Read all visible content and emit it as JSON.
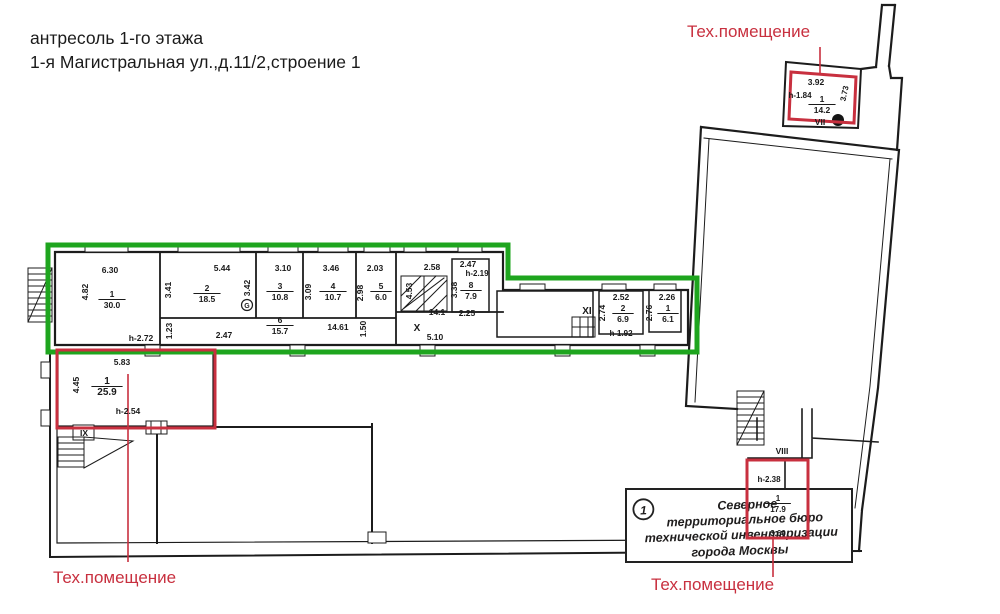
{
  "title": {
    "line1": "антресоль 1-го этажа",
    "line2": "1-я Магистральная ул.,д.11/2,строение 1"
  },
  "legend": {
    "tech_room_top_right": "Тех.помещение",
    "tech_room_bottom_left": "Тех.помещение",
    "tech_room_bottom_right": "Тех.помещение"
  },
  "stamp": {
    "number": "1",
    "lines": [
      "Северное",
      "территориальное бюро",
      "технической инвентаризации",
      "города Москвы"
    ]
  },
  "colors": {
    "highlight_green": "#1ea51e",
    "highlight_red": "#c8303f",
    "ink": "#1a1a1a"
  },
  "plan": {
    "labels": [
      {
        "t": "6.30",
        "x": 110,
        "y": 273
      },
      {
        "t": "4.82",
        "x": 88,
        "y": 292,
        "r": -90
      },
      {
        "t": "1",
        "x": 112,
        "y": 297,
        "fr": "30.0"
      },
      {
        "t": "h-2.72",
        "x": 141,
        "y": 341
      },
      {
        "t": "5.44",
        "x": 222,
        "y": 271
      },
      {
        "t": "3.41",
        "x": 171,
        "y": 290,
        "r": -90
      },
      {
        "t": "2",
        "x": 207,
        "y": 291,
        "fr": "18.5"
      },
      {
        "t": "3.42",
        "x": 250,
        "y": 288,
        "r": -90
      },
      {
        "t": "3.10",
        "x": 283,
        "y": 271
      },
      {
        "t": "3",
        "x": 280,
        "y": 289,
        "fr": "10.8"
      },
      {
        "t": "3.46",
        "x": 331,
        "y": 271
      },
      {
        "t": "3.09",
        "x": 311,
        "y": 292,
        "r": -90
      },
      {
        "t": "4",
        "x": 333,
        "y": 289,
        "fr": "10.7"
      },
      {
        "t": "2.03",
        "x": 375,
        "y": 271
      },
      {
        "t": "2.98",
        "x": 363,
        "y": 293,
        "r": -90
      },
      {
        "t": "5",
        "x": 381,
        "y": 289,
        "fr": "6.0"
      },
      {
        "t": "6",
        "x": 280,
        "y": 323,
        "fr": "15.7"
      },
      {
        "t": "1.23",
        "x": 172,
        "y": 331,
        "r": -90
      },
      {
        "t": "2.47",
        "x": 224,
        "y": 338
      },
      {
        "t": "14.61",
        "x": 338,
        "y": 330
      },
      {
        "t": "1.50",
        "x": 366,
        "y": 329,
        "r": -90
      },
      {
        "t": "2.58",
        "x": 432,
        "y": 270
      },
      {
        "t": "4.53",
        "x": 412,
        "y": 291,
        "r": -90
      },
      {
        "t": "14.1",
        "x": 437,
        "y": 315
      },
      {
        "t": "X",
        "x": 417,
        "y": 331,
        "b": 1,
        "s": 10
      },
      {
        "t": "5.10",
        "x": 435,
        "y": 340
      },
      {
        "t": "2.47",
        "x": 468,
        "y": 267
      },
      {
        "t": "h-2.19",
        "x": 477,
        "y": 276,
        "s": 8
      },
      {
        "t": "3.38",
        "x": 457,
        "y": 290,
        "r": -90
      },
      {
        "t": "8",
        "x": 471,
        "y": 288,
        "fr": "7.9"
      },
      {
        "t": "2.25",
        "x": 467,
        "y": 316
      },
      {
        "t": "XI",
        "x": 587,
        "y": 314,
        "b": 1,
        "s": 10
      },
      {
        "t": "2.52",
        "x": 621,
        "y": 300
      },
      {
        "t": "2.74",
        "x": 605,
        "y": 313,
        "r": -90
      },
      {
        "t": "2",
        "x": 623,
        "y": 311,
        "fr": "6.9"
      },
      {
        "t": "h-1.92",
        "x": 621,
        "y": 336,
        "s": 8
      },
      {
        "t": "2.26",
        "x": 667,
        "y": 300
      },
      {
        "t": "2.76",
        "x": 652,
        "y": 313,
        "r": -90
      },
      {
        "t": "1",
        "x": 668,
        "y": 311,
        "fr": "6.1"
      },
      {
        "t": "5.83",
        "x": 122,
        "y": 365
      },
      {
        "t": "4.45",
        "x": 79,
        "y": 385,
        "r": -90
      },
      {
        "t": "1",
        "x": 107,
        "y": 384,
        "fr": "25.9",
        "s": 10
      },
      {
        "t": "h-2.54",
        "x": 128,
        "y": 414
      },
      {
        "t": "IX",
        "x": 84,
        "y": 436,
        "b": 1
      },
      {
        "t": "3.92",
        "x": 816,
        "y": 85
      },
      {
        "t": "h-1.84",
        "x": 800,
        "y": 98,
        "s": 8
      },
      {
        "t": "3.73",
        "x": 847,
        "y": 94,
        "r": -78,
        "s": 8
      },
      {
        "t": "1",
        "x": 822,
        "y": 102,
        "fr": "14.2"
      },
      {
        "t": "VII",
        "x": 820,
        "y": 125,
        "b": 1
      },
      {
        "t": "VIII",
        "x": 782,
        "y": 454,
        "b": 1
      },
      {
        "t": "h-2.38",
        "x": 769,
        "y": 482,
        "s": 8
      },
      {
        "t": "1",
        "x": 778,
        "y": 501,
        "fr": "17.9",
        "s": 8
      },
      {
        "t": "3.60",
        "x": 778,
        "y": 536,
        "s": 8
      },
      {
        "t": "G",
        "x": 247,
        "y": 308,
        "s": 7
      }
    ]
  }
}
